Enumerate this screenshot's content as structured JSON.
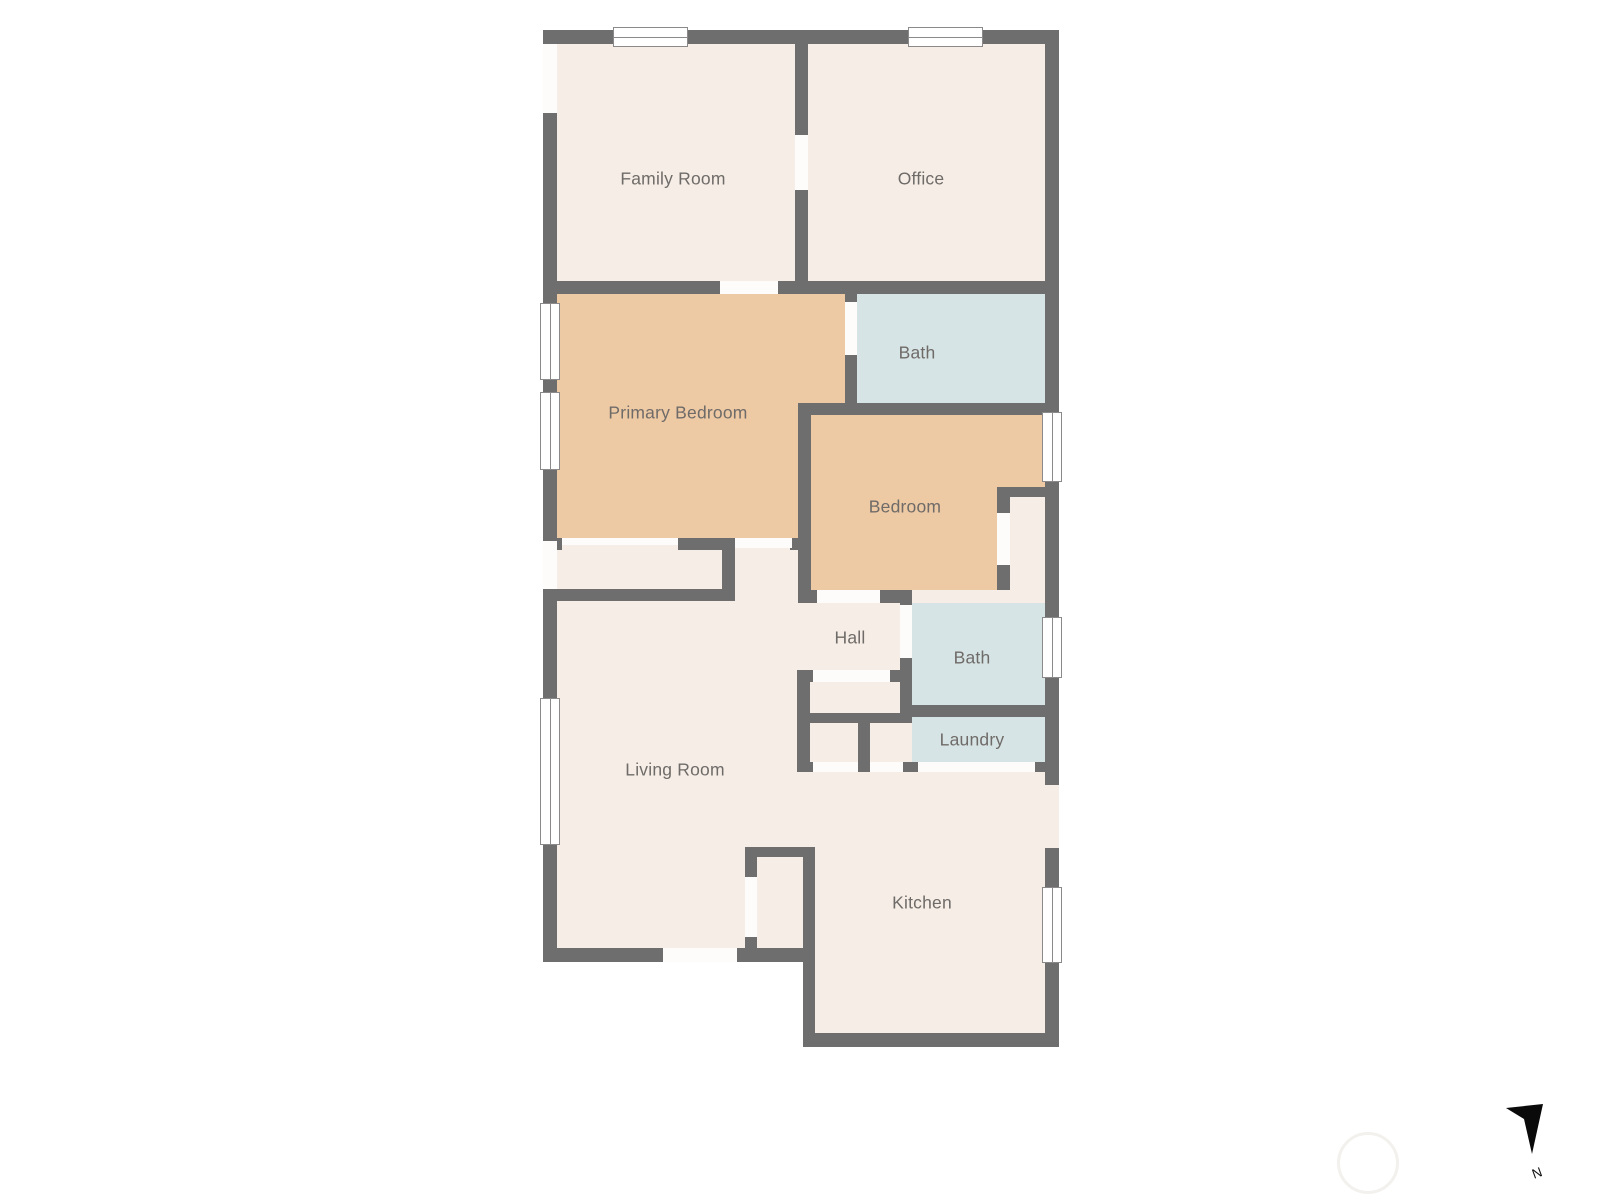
{
  "page": {
    "background": "#ffffff"
  },
  "colors": {
    "wall": "#6f6e6e",
    "cream": "#f5ede6",
    "orange": "#edc9a4",
    "blue": "#d7e4e5",
    "opening_white": "#fdfcfa",
    "window_border": "#8b8989",
    "label_text": "#6f6b68",
    "compass_black": "#0a0a0a"
  },
  "rooms": [
    {
      "id": "family-room",
      "label": "Family Room",
      "floor_color": "cream",
      "cx": 673,
      "cy": 179
    },
    {
      "id": "office",
      "label": "Office",
      "floor_color": "cream",
      "cx": 921,
      "cy": 179
    },
    {
      "id": "primary-bedroom",
      "label": "Primary Bedroom",
      "floor_color": "orange",
      "cx": 678,
      "cy": 413
    },
    {
      "id": "bath-upper",
      "label": "Bath",
      "floor_color": "blue",
      "cx": 917,
      "cy": 353
    },
    {
      "id": "bedroom",
      "label": "Bedroom",
      "floor_color": "orange",
      "cx": 905,
      "cy": 507
    },
    {
      "id": "hall",
      "label": "Hall",
      "floor_color": "cream",
      "cx": 850,
      "cy": 638
    },
    {
      "id": "bath-lower",
      "label": "Bath",
      "floor_color": "blue",
      "cx": 972,
      "cy": 658
    },
    {
      "id": "laundry",
      "label": "Laundry",
      "floor_color": "blue",
      "cx": 972,
      "cy": 740
    },
    {
      "id": "living-room",
      "label": "Living Room",
      "floor_color": "cream",
      "cx": 675,
      "cy": 770
    },
    {
      "id": "kitchen",
      "label": "Kitchen",
      "floor_color": "cream",
      "cx": 922,
      "cy": 903
    }
  ],
  "compass": {
    "label": "N",
    "arrow_points": "26,18 63,14 52,64 44,29"
  },
  "geometry": {
    "floors": [
      {
        "n": "base-main",
        "x": 543,
        "y": 30,
        "w": 516,
        "h": 932,
        "c": "cream"
      },
      {
        "n": "base-kitchen",
        "x": 803,
        "y": 772,
        "w": 256,
        "h": 275,
        "c": "cream"
      },
      {
        "n": "primary-bedroom-a",
        "x": 557,
        "y": 294,
        "w": 288,
        "h": 109,
        "c": "orange"
      },
      {
        "n": "primary-bedroom-b",
        "x": 557,
        "y": 294,
        "w": 241,
        "h": 244,
        "c": "orange"
      },
      {
        "n": "bath-upper",
        "x": 857,
        "y": 294,
        "w": 188,
        "h": 109,
        "c": "blue"
      },
      {
        "n": "bedroom-a",
        "x": 811,
        "y": 415,
        "w": 234,
        "h": 72,
        "c": "orange"
      },
      {
        "n": "bedroom-b",
        "x": 811,
        "y": 415,
        "w": 186,
        "h": 175,
        "c": "orange"
      },
      {
        "n": "bath-lower",
        "x": 912,
        "y": 603,
        "w": 133,
        "h": 102,
        "c": "blue"
      },
      {
        "n": "laundry",
        "x": 912,
        "y": 717,
        "w": 133,
        "h": 45,
        "c": "blue"
      }
    ],
    "walls": [
      {
        "x": 543,
        "y": 30,
        "w": 516,
        "h": 14
      },
      {
        "x": 543,
        "y": 30,
        "w": 14,
        "h": 932
      },
      {
        "x": 1045,
        "y": 30,
        "w": 14,
        "h": 1017
      },
      {
        "x": 543,
        "y": 948,
        "w": 272,
        "h": 14
      },
      {
        "x": 803,
        "y": 1033,
        "w": 256,
        "h": 14
      },
      {
        "x": 803,
        "y": 847,
        "w": 12,
        "h": 200
      },
      {
        "x": 795,
        "y": 44,
        "w": 13,
        "h": 237
      },
      {
        "x": 543,
        "y": 281,
        "w": 516,
        "h": 13
      },
      {
        "x": 845,
        "y": 294,
        "w": 12,
        "h": 109
      },
      {
        "x": 798,
        "y": 403,
        "w": 247,
        "h": 12
      },
      {
        "x": 798,
        "y": 403,
        "w": 13,
        "h": 187
      },
      {
        "x": 790,
        "y": 538,
        "w": 8,
        "h": 12
      },
      {
        "x": 798,
        "y": 590,
        "w": 114,
        "h": 13
      },
      {
        "x": 997,
        "y": 487,
        "w": 48,
        "h": 10
      },
      {
        "x": 997,
        "y": 487,
        "w": 13,
        "h": 103
      },
      {
        "x": 543,
        "y": 538,
        "w": 19,
        "h": 12
      },
      {
        "x": 678,
        "y": 538,
        "w": 57,
        "h": 12
      },
      {
        "x": 722,
        "y": 538,
        "w": 13,
        "h": 63
      },
      {
        "x": 543,
        "y": 589,
        "w": 192,
        "h": 12
      },
      {
        "x": 900,
        "y": 590,
        "w": 12,
        "h": 127
      },
      {
        "x": 900,
        "y": 705,
        "w": 145,
        "h": 12
      },
      {
        "x": 797,
        "y": 670,
        "w": 106,
        "h": 12
      },
      {
        "x": 797,
        "y": 670,
        "w": 13,
        "h": 102
      },
      {
        "x": 797,
        "y": 713,
        "w": 115,
        "h": 10
      },
      {
        "x": 858,
        "y": 723,
        "w": 12,
        "h": 49
      },
      {
        "x": 797,
        "y": 762,
        "w": 262,
        "h": 10
      },
      {
        "x": 745,
        "y": 847,
        "w": 70,
        "h": 10
      },
      {
        "x": 745,
        "y": 847,
        "w": 12,
        "h": 115
      }
    ],
    "openings": [
      {
        "x": 795,
        "y": 135,
        "w": 13,
        "h": 55
      },
      {
        "x": 720,
        "y": 281,
        "w": 58,
        "h": 13
      },
      {
        "x": 845,
        "y": 302,
        "w": 12,
        "h": 53
      },
      {
        "x": 562,
        "y": 538,
        "w": 116,
        "h": 7
      },
      {
        "x": 735,
        "y": 538,
        "w": 57,
        "h": 10
      },
      {
        "x": 817,
        "y": 590,
        "w": 63,
        "h": 13
      },
      {
        "x": 997,
        "y": 513,
        "w": 13,
        "h": 52
      },
      {
        "x": 900,
        "y": 605,
        "w": 12,
        "h": 53
      },
      {
        "x": 813,
        "y": 670,
        "w": 77,
        "h": 12
      },
      {
        "x": 813,
        "y": 762,
        "w": 45,
        "h": 10
      },
      {
        "x": 870,
        "y": 762,
        "w": 33,
        "h": 10
      },
      {
        "x": 918,
        "y": 762,
        "w": 117,
        "h": 10
      },
      {
        "x": 745,
        "y": 877,
        "w": 12,
        "h": 60
      },
      {
        "x": 663,
        "y": 948,
        "w": 74,
        "h": 14
      },
      {
        "x": 543,
        "y": 44,
        "w": 14,
        "h": 69
      },
      {
        "x": 543,
        "y": 541,
        "w": 14,
        "h": 48
      },
      {
        "x": 1045,
        "y": 785,
        "w": 14,
        "h": 63,
        "c": "cream"
      }
    ],
    "windows": [
      {
        "x": 613,
        "y": 27,
        "w": 75,
        "h": 20,
        "o": "h"
      },
      {
        "x": 908,
        "y": 27,
        "w": 75,
        "h": 20,
        "o": "h"
      },
      {
        "x": 540,
        "y": 303,
        "w": 20,
        "h": 77,
        "o": "v"
      },
      {
        "x": 540,
        "y": 392,
        "w": 20,
        "h": 78,
        "o": "v"
      },
      {
        "x": 540,
        "y": 698,
        "w": 20,
        "h": 147,
        "o": "v"
      },
      {
        "x": 1042,
        "y": 412,
        "w": 20,
        "h": 70,
        "o": "v"
      },
      {
        "x": 1042,
        "y": 617,
        "w": 20,
        "h": 61,
        "o": "v"
      },
      {
        "x": 1042,
        "y": 887,
        "w": 20,
        "h": 76,
        "o": "v"
      }
    ]
  }
}
